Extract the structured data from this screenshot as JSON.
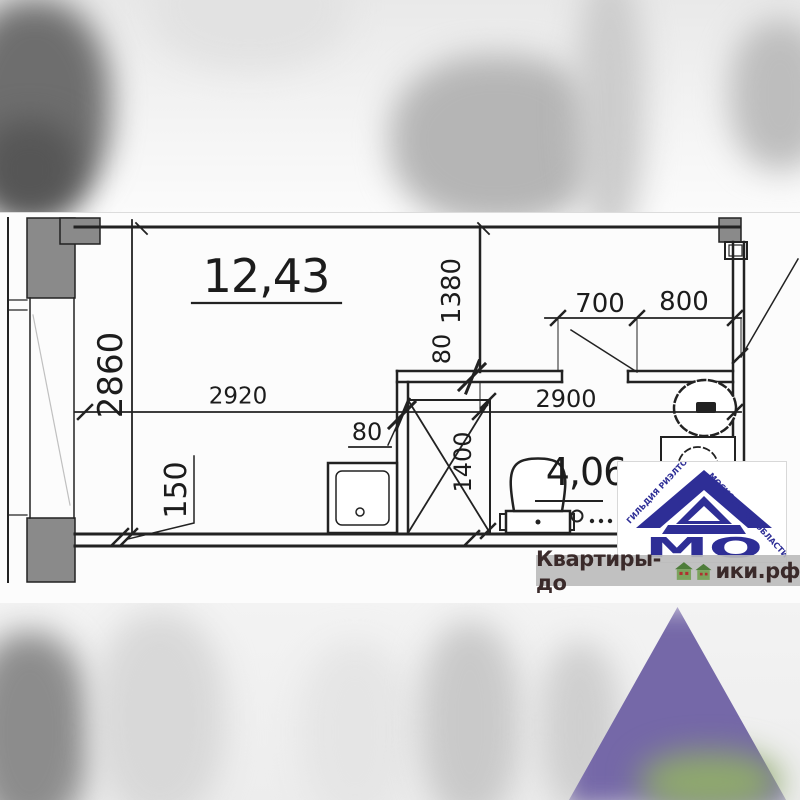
{
  "plan": {
    "areas": {
      "main": "12,43",
      "bath": "4,06"
    },
    "dimensions": {
      "left_height": "2860",
      "main_width": "2920",
      "right_width": "2900",
      "inner_wall_height": "1380",
      "partition_thickness_top": "80",
      "partition_thickness_left": "80",
      "bath_door_width": "700",
      "entry_width": "800",
      "shaft_depth": "1400",
      "ledge_offset": "150"
    },
    "fixtures": [
      "shower-tray",
      "vent-shaft-x",
      "toilet",
      "wall-sink",
      "washing-machine",
      "drain-symbol"
    ]
  },
  "logo": {
    "guild_arc_left": "ГИЛЬДИЯ РИЭЛТОРОВ",
    "guild_arc_right": "МОСКОВСКОЙ ОБЛАСТИ",
    "monogram": "МО"
  },
  "watermark": {
    "site_prefix": "Квартиры-до",
    "site_suffix": "ики.рф"
  },
  "colors": {
    "drawing_line": "#222222",
    "wall_fill": "#8a8a8a",
    "logo_navy": "#2e2e96",
    "watermark_text": "#3a2a2a",
    "house_green": "#7ba35d",
    "blur_purple": "#7568a8"
  }
}
